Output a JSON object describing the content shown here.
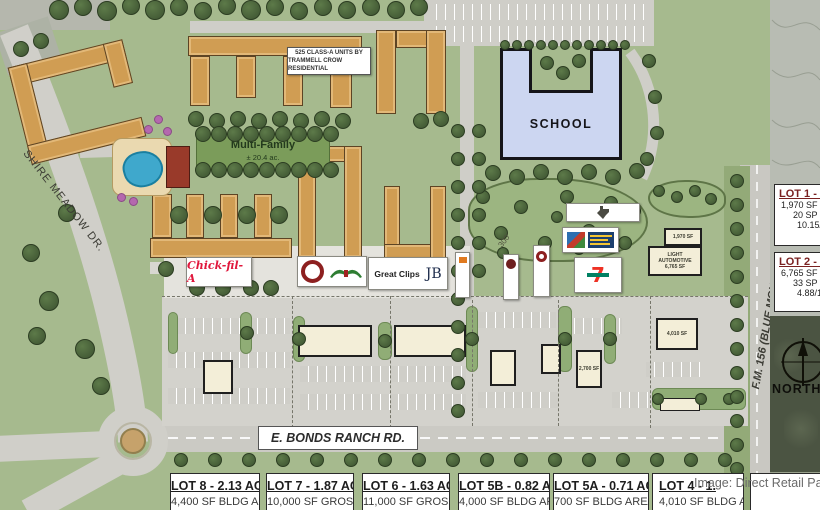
{
  "site": {
    "residential_note_line1": "525 CLASS-A UNITS BY",
    "residential_note_line2": "TRAMMELL CROW RESIDENTIAL",
    "multifamily_title": "Multi-Family",
    "multifamily_area": "± 20.4 ac.",
    "school_label": "SCHOOL",
    "north_label": "NORTH",
    "dim_300": "300'"
  },
  "streets": {
    "shire_meadow": "SHIRE MEADOW DR.",
    "bonds_ranch": "E. BONDS RANCH RD.",
    "fm_156": "F.M. 156 (BLUE MOUND RD.)"
  },
  "side_lots": [
    {
      "title": "LOT 1 - 0.",
      "line1": "1,970 SF BL",
      "line2": "20 SP P",
      "line3": "10.15/1"
    },
    {
      "title": "LOT 2 - 0.",
      "line1": "6,765 SF BL",
      "line2": "33 SP P",
      "line3": "4.88/1"
    }
  ],
  "bottom_lots": [
    {
      "title": "LOT 8 - 2.13 AC.",
      "sub": "4,400 SF BLDG AREA"
    },
    {
      "title": "LOT 7 - 1.87 AC.",
      "sub": "10,000 SF GROSS"
    },
    {
      "title": "LOT 6 - 1.63 AC.",
      "sub": "11,000 SF GROSS"
    },
    {
      "title": "LOT 5B - 0.82 AC.",
      "sub": "4,000 SF BLDG AREA"
    },
    {
      "title": "LOT 5A - 0.71 AC.",
      "sub": "700 SF BLDG AREA"
    },
    {
      "title": "LOT 4 - 1.",
      "sub": "4,010 SF BLDG AREA"
    }
  ],
  "buildings": {
    "quick_pad_sf": "1,970 SF",
    "light_auto_1": "LIGHT",
    "light_auto_2": "AUTOMOTIVE",
    "light_auto_sf": "6,765 SF",
    "pad_4010_sf": "4,010 SF",
    "pad_2700_sf": "2,700 SF"
  },
  "tenants": {
    "chick_fil_a": "Chick-fil-A",
    "great_clips": "Great Clips",
    "jb_monogram": "JB",
    "seven": "7"
  },
  "credit": "Image: Direct Retail Pa"
}
